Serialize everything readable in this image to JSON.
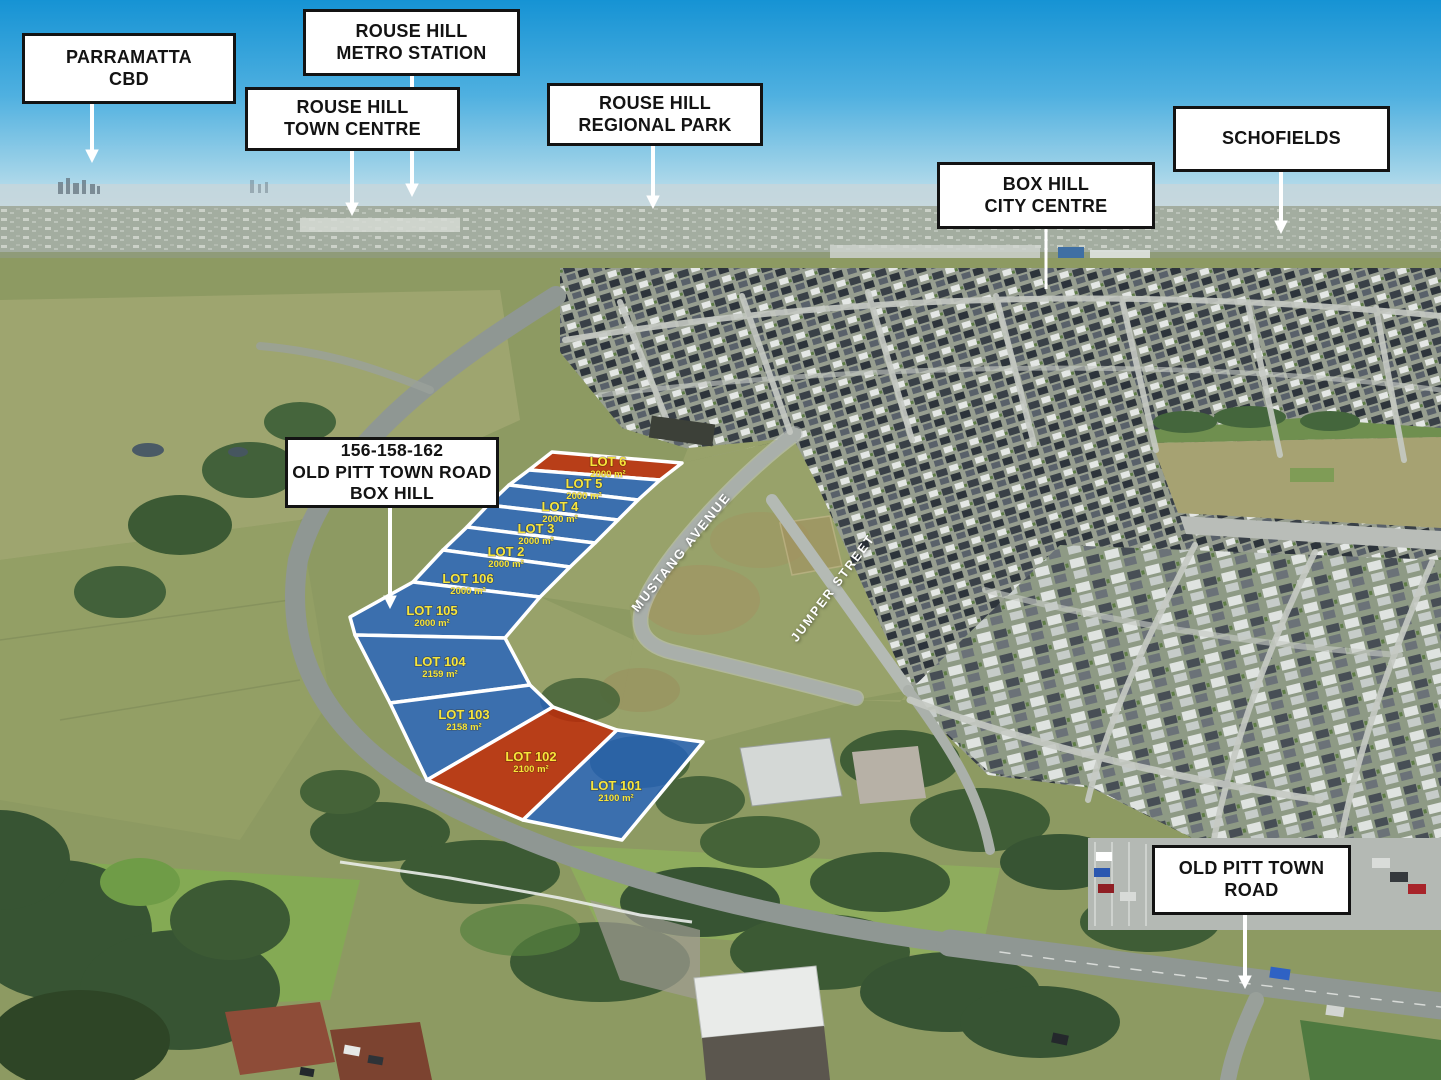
{
  "location_labels": [
    {
      "id": "parramatta-cbd",
      "lines": [
        "PARRAMATTA",
        "CBD"
      ]
    },
    {
      "id": "rouse-hill-metro-station",
      "lines": [
        "ROUSE HILL",
        "METRO STATION"
      ]
    },
    {
      "id": "rouse-hill-town-centre",
      "lines": [
        "ROUSE HILL",
        "TOWN CENTRE"
      ]
    },
    {
      "id": "rouse-hill-regional-park",
      "lines": [
        "ROUSE HILL",
        "REGIONAL PARK"
      ]
    },
    {
      "id": "box-hill-city-centre",
      "lines": [
        "BOX HILL",
        "CITY CENTRE"
      ]
    },
    {
      "id": "schofields",
      "lines": [
        "SCHOFIELDS"
      ]
    },
    {
      "id": "property-address",
      "lines": [
        "156-158-162",
        "OLD PITT TOWN ROAD",
        "BOX HILL"
      ]
    },
    {
      "id": "old-pitt-town-road",
      "lines": [
        "OLD PITT TOWN",
        "ROAD"
      ]
    }
  ],
  "streets": [
    {
      "name": "MUSTANG AVENUE"
    },
    {
      "name": "JUMPER STREET"
    }
  ],
  "lots": [
    {
      "name": "LOT 6",
      "area": "2000 m²",
      "status": "highlighted"
    },
    {
      "name": "LOT 5",
      "area": "2000 m²",
      "status": "available"
    },
    {
      "name": "LOT 4",
      "area": "2000 m²",
      "status": "available"
    },
    {
      "name": "LOT 3",
      "area": "2000 m²",
      "status": "available"
    },
    {
      "name": "LOT 2",
      "area": "2000 m²",
      "status": "available"
    },
    {
      "name": "LOT 106",
      "area": "2000 m²",
      "status": "available"
    },
    {
      "name": "LOT 105",
      "area": "2000 m²",
      "status": "available"
    },
    {
      "name": "LOT 104",
      "area": "2159 m²",
      "status": "available"
    },
    {
      "name": "LOT 103",
      "area": "2158 m²",
      "status": "available"
    },
    {
      "name": "LOT 102",
      "area": "2100 m²",
      "status": "highlighted"
    },
    {
      "name": "LOT 101",
      "area": "2100 m²",
      "status": "available"
    }
  ],
  "colors": {
    "lot_available_fill": "#2161c6",
    "lot_highlight_fill": "#c32706",
    "lot_border": "#ffffff",
    "lot_text": "#f7e53a",
    "label_background": "#ffffff",
    "label_border": "#131313",
    "label_text": "#131313",
    "arrow": "#ffffff",
    "sky_top": "#1693d4",
    "sky_horizon": "#cfe4ec"
  }
}
